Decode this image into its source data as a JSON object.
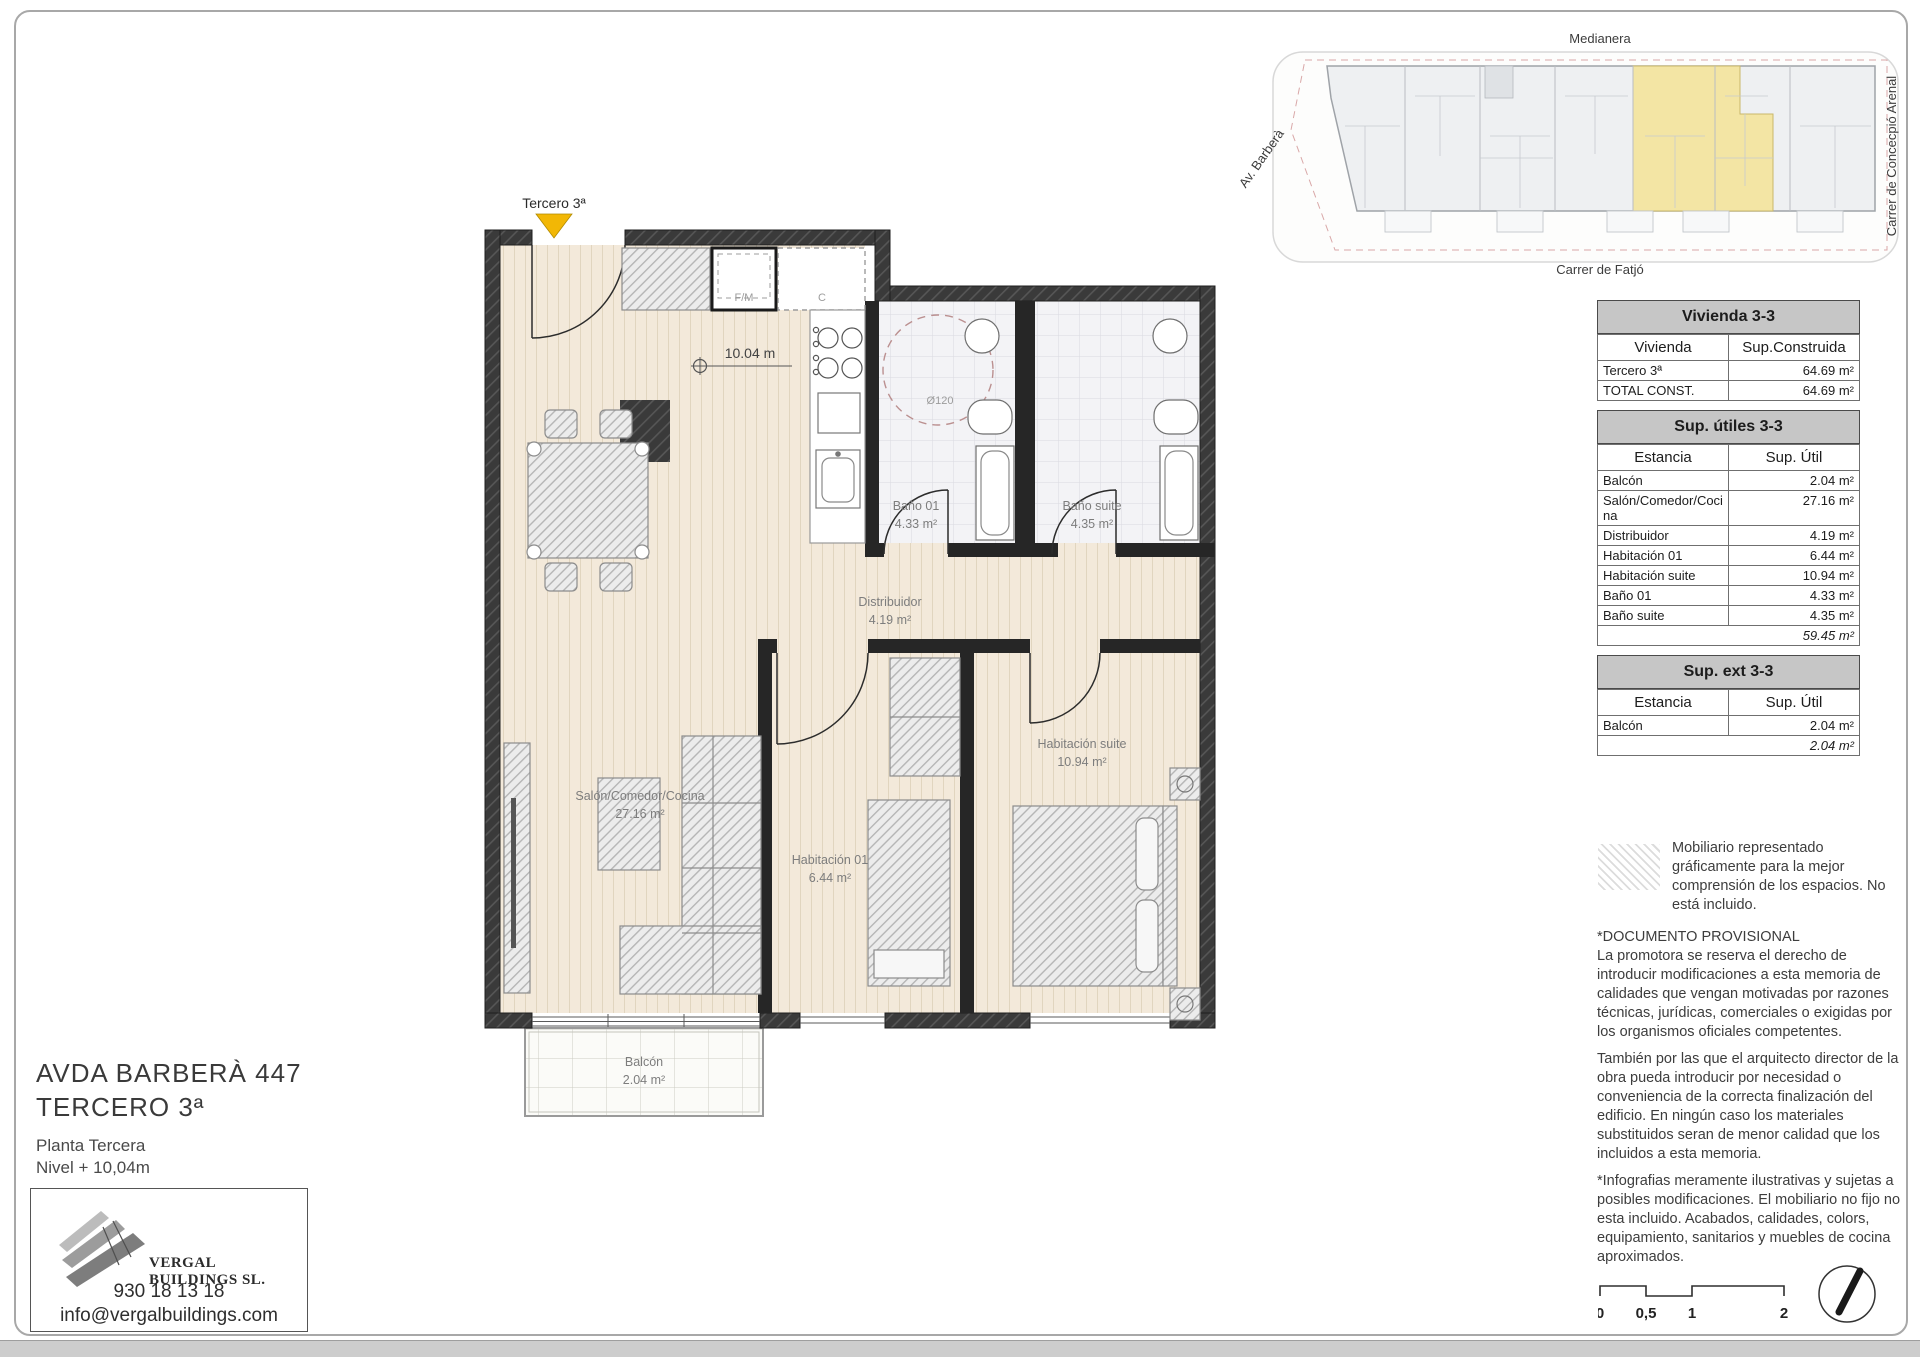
{
  "key_plan": {
    "street_top": "Medianera",
    "street_left": "Av. Barberà",
    "street_right": "Carrer de Concecpió Arenal",
    "street_bottom": "Carrer de Fatjó",
    "highlight_color": "#f3e5a4"
  },
  "plan": {
    "entry_label": "Tercero 3ª",
    "level_label": "10.04 m",
    "turning_circle_label": "Ø120",
    "appliances": {
      "fm": "F/M",
      "c": "C"
    },
    "rooms": {
      "salon": {
        "name": "Salón/Comedor/Cocina",
        "area": "27.16 m²"
      },
      "distribuidor": {
        "name": "Distribuidor",
        "area": "4.19 m²"
      },
      "bano01": {
        "name": "Baño 01",
        "area": "4.33 m²"
      },
      "banosuite": {
        "name": "Baño suite",
        "area": "4.35 m²"
      },
      "hab01": {
        "name": "Habitación 01",
        "area": "6.44 m²"
      },
      "habsuite": {
        "name": "Habitación suite",
        "area": "10.94 m²"
      },
      "balcon": {
        "name": "Balcón",
        "area": "2.04 m²"
      }
    }
  },
  "tables": {
    "vivienda": {
      "title": "Vivienda 3-3",
      "headers": [
        "Vivienda",
        "Sup.Construida"
      ],
      "rows": [
        [
          "Tercero 3ª",
          "64.69 m²"
        ],
        [
          "TOTAL CONST.",
          "64.69 m²"
        ]
      ]
    },
    "utiles": {
      "title": "Sup. útiles 3-3",
      "headers": [
        "Estancia",
        "Sup. Útil"
      ],
      "rows": [
        [
          "Balcón",
          "2.04 m²"
        ],
        [
          "Salón/Comedor/Cocina",
          "27.16 m²"
        ],
        [
          "Distribuidor",
          "4.19 m²"
        ],
        [
          "Habitación 01",
          "6.44 m²"
        ],
        [
          "Habitación suite",
          "10.94 m²"
        ],
        [
          "Baño 01",
          "4.33 m²"
        ],
        [
          "Baño suite",
          "4.35 m²"
        ]
      ],
      "total": "59.45 m²"
    },
    "ext": {
      "title": "Sup. ext 3-3",
      "headers": [
        "Estancia",
        "Sup. Útil"
      ],
      "rows": [
        [
          "Balcón",
          "2.04 m²"
        ]
      ],
      "total": "2.04 m²"
    }
  },
  "notes": {
    "furniture_legend": "Mobiliario representado gráficamente para la mejor comprensión de los espacios. No está incluido.",
    "provisional_title": "*DOCUMENTO PROVISIONAL",
    "provisional_body": "La promotora se reserva el derecho de introducir modificaciones a esta memoria de calidades que vengan motivadas por razones técnicas, jurídicas, comerciales o exigidas por los organismos oficiales competentes.",
    "architect_note": "También por las que el arquitecto director de la obra pueda introducir por necesidad o conveniencia de la correcta finalización del edificio. En ningún caso los materiales substituidos seran de menor calidad que los incluidos a esta memoria.",
    "infographics_note": "*Infografias meramente ilustrativas y sujetas a posibles modificaciones. El mobiliario no fijo no esta incluido. Acabados, calidades, colors, equipamiento, sanitarios y muebles de cocina aproximados."
  },
  "title_block": {
    "address_line1": "AVDA BARBERÀ 447",
    "address_line2": "TERCERO 3ª",
    "floor": "Planta Tercera",
    "level": "Nivel + 10,04m",
    "company": "VERGAL BUILDINGS SL.",
    "phone": "930 18 13 18",
    "email": "info@vergalbuildings.com"
  },
  "scale_bar": {
    "labels": [
      "0",
      "0,5",
      "1",
      "2"
    ]
  }
}
